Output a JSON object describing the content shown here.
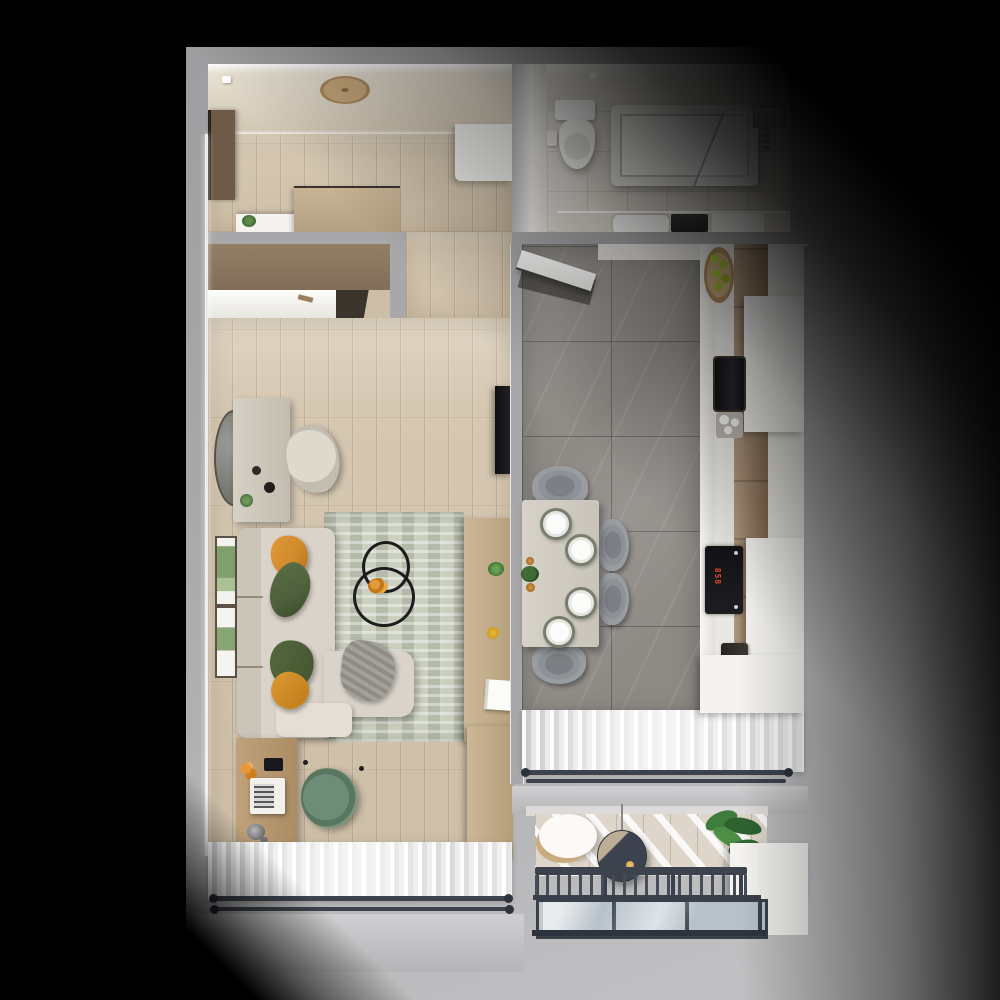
{
  "scene": {
    "type": "3d-floor-plan-render",
    "description": "Top-down 3D render of a one-bedroom apartment on a gray mat with black vignette",
    "cooktop_display": "858",
    "rooms": [
      {
        "name": "entry-hall",
        "floor": "light-oak-planks",
        "items": [
          "entrance-door",
          "ceiling-light",
          "smoke-detector",
          "shoe-cabinet-with-plant",
          "low-wardrobe",
          "built-in-closet-sliding-door",
          "white-hall-cabinet"
        ]
      },
      {
        "name": "bathroom",
        "floor": "beige-tile",
        "items": [
          "toilet",
          "toilet-paper-holder",
          "bathtub",
          "glass-screen",
          "shower-set",
          "vanity-counter",
          "sink",
          "washing-machine",
          "white-unit",
          "ceiling-spots"
        ]
      },
      {
        "name": "living-room",
        "floor": "light-oak-planks",
        "items": [
          "round-wall-mirror",
          "console-table",
          "vanity-chair",
          "wall-tv",
          "botanical-art-frame",
          "botanical-art-frame",
          "corner-sofa",
          "orange-pillow",
          "green-pillow",
          "green-pillow",
          "orange-pillow",
          "gray-throw",
          "boucle-rug",
          "nesting-wire-coffee-tables",
          "orange-flowers",
          "media-sideboard",
          "desk",
          "laptop",
          "desk-lamp",
          "smartphone",
          "office-chair",
          "tall-wardrobe",
          "sheer-curtains",
          "double-curtain-rod"
        ]
      },
      {
        "name": "kitchen-dining",
        "floor": "gray-marble-tile",
        "items": [
          "open-white-door",
          "tall-cabinet-column",
          "fruit-bowl-with-apples",
          "built-in-oven",
          "glass-set",
          "induction-cooktop",
          "coffee-machine",
          "white-cabinet-boxes",
          "dining-table",
          "place-setting",
          "place-setting",
          "place-setting",
          "place-setting",
          "candles",
          "table-plant",
          "dining-chair",
          "dining-chair",
          "dining-chair",
          "dining-chair",
          "sheer-curtains",
          "double-curtain-rod"
        ]
      },
      {
        "name": "balcony",
        "floor": "whitewashed-planks-sunlit",
        "items": [
          "rattan-chair",
          "hanging-chair",
          "potted-plant",
          "white-planter-wall",
          "metal-railing",
          "balusters",
          "glass-balustrade"
        ]
      }
    ],
    "colors": {
      "mat": "#a8a8aa",
      "wood": "#d5c7b1",
      "marble": "#8e8a85",
      "bath-tile": "#d6d1c8",
      "ceiling": "#e6dfd1",
      "white": "#f4f3f0",
      "rug": "#ccd0c1",
      "sofa": "#d9d3ca",
      "pillow-orange": "#d08a2c",
      "pillow-green": "#4d603c",
      "desk-wood": "#bfa17b",
      "cabinet-wood": "#997c5e",
      "closet-wood": "#937e66",
      "chair-sage": "#76957f",
      "chair-gray": "#8e9296",
      "table": "#d6d2c8",
      "metal": "#3c434d",
      "glass": "#b6c1c9",
      "display-red": "#e8442a",
      "door-brown": "#6e5a47",
      "apple-green": "#a8c43c"
    }
  }
}
